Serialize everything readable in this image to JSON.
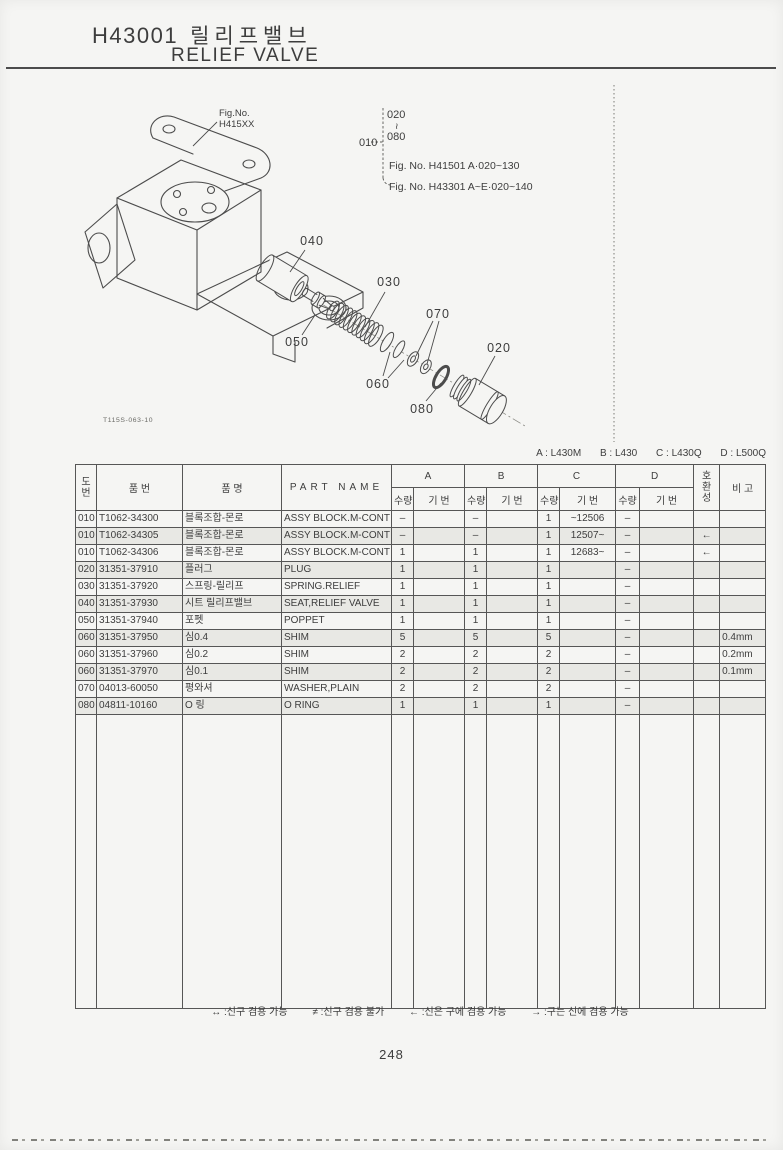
{
  "page": {
    "title_code": "H43001",
    "title_kr": "릴리프밸브",
    "title_en": "RELIEF VALVE",
    "page_number": "248"
  },
  "diagram": {
    "fig_no_label": "Fig.No.",
    "fig_no_value": "H415XX",
    "drawing_code": "T115S-063-10",
    "callouts": {
      "c010": "010",
      "c020": "020",
      "c030": "030",
      "c040": "040",
      "c050": "050",
      "c060": "060",
      "c070": "070",
      "c080": "080"
    },
    "serial_note": {
      "item": "010",
      "range_start": "020",
      "range_end": "080",
      "tilde": "~",
      "refs": [
        "Fig. No. H41501  A·020~130",
        "Fig. No. H43301  A~E·020~140"
      ]
    }
  },
  "models_note": {
    "items": [
      "A : L430M",
      "B : L430",
      "C : L430Q",
      "D : L500Q"
    ]
  },
  "table": {
    "headers": {
      "fig_no": [
        "도",
        "번"
      ],
      "part_no": "품    번",
      "name_kr": "품    명",
      "part_name": "PART NAME",
      "group_a": "A",
      "group_b": "B",
      "group_c": "C",
      "group_d": "D",
      "qty": "수량",
      "serial": "기 번",
      "compat": [
        "호",
        "환",
        "성"
      ],
      "remark": "비  고"
    },
    "rows": [
      {
        "no": "010",
        "part_no": "T1062-34300",
        "name_kr": "블록조합-몬로",
        "name_en": "ASSY BLOCK.M-CONT",
        "a_qty": "–",
        "a_ser": "",
        "b_qty": "–",
        "b_ser": "",
        "c_qty": "1",
        "c_ser": "~12506",
        "d_qty": "–",
        "d_ser": "",
        "compat": "",
        "remark": ""
      },
      {
        "no": "010",
        "part_no": "T1062-34305",
        "name_kr": "블록조합-몬로",
        "name_en": "ASSY BLOCK.M-CONT",
        "a_qty": "–",
        "a_ser": "",
        "b_qty": "–",
        "b_ser": "",
        "c_qty": "1",
        "c_ser": "12507~",
        "d_qty": "–",
        "d_ser": "",
        "compat": "←",
        "remark": ""
      },
      {
        "no": "010",
        "part_no": "T1062-34306",
        "name_kr": "블록조합-몬로",
        "name_en": "ASSY BLOCK.M-CONT",
        "a_qty": "1",
        "a_ser": "",
        "b_qty": "1",
        "b_ser": "",
        "c_qty": "1",
        "c_ser": "12683~",
        "d_qty": "–",
        "d_ser": "",
        "compat": "←",
        "remark": ""
      },
      {
        "no": "020",
        "part_no": "31351-37910",
        "name_kr": "플러그",
        "name_en": "PLUG",
        "a_qty": "1",
        "a_ser": "",
        "b_qty": "1",
        "b_ser": "",
        "c_qty": "1",
        "c_ser": "",
        "d_qty": "–",
        "d_ser": "",
        "compat": "",
        "remark": ""
      },
      {
        "no": "030",
        "part_no": "31351-37920",
        "name_kr": "스프링-릴리프",
        "name_en": "SPRING.RELIEF",
        "a_qty": "1",
        "a_ser": "",
        "b_qty": "1",
        "b_ser": "",
        "c_qty": "1",
        "c_ser": "",
        "d_qty": "–",
        "d_ser": "",
        "compat": "",
        "remark": ""
      },
      {
        "no": "040",
        "part_no": "31351-37930",
        "name_kr": "시트 릴리프밸브",
        "name_en": "SEAT,RELIEF VALVE",
        "a_qty": "1",
        "a_ser": "",
        "b_qty": "1",
        "b_ser": "",
        "c_qty": "1",
        "c_ser": "",
        "d_qty": "–",
        "d_ser": "",
        "compat": "",
        "remark": ""
      },
      {
        "no": "050",
        "part_no": "31351-37940",
        "name_kr": "포펫",
        "name_en": "POPPET",
        "a_qty": "1",
        "a_ser": "",
        "b_qty": "1",
        "b_ser": "",
        "c_qty": "1",
        "c_ser": "",
        "d_qty": "–",
        "d_ser": "",
        "compat": "",
        "remark": ""
      },
      {
        "no": "060",
        "part_no": "31351-37950",
        "name_kr": "심0.4",
        "name_en": "SHIM",
        "a_qty": "5",
        "a_ser": "",
        "b_qty": "5",
        "b_ser": "",
        "c_qty": "5",
        "c_ser": "",
        "d_qty": "–",
        "d_ser": "",
        "compat": "",
        "remark": "0.4mm"
      },
      {
        "no": "060",
        "part_no": "31351-37960",
        "name_kr": "심0.2",
        "name_en": "SHIM",
        "a_qty": "2",
        "a_ser": "",
        "b_qty": "2",
        "b_ser": "",
        "c_qty": "2",
        "c_ser": "",
        "d_qty": "–",
        "d_ser": "",
        "compat": "",
        "remark": "0.2mm"
      },
      {
        "no": "060",
        "part_no": "31351-37970",
        "name_kr": "심0.1",
        "name_en": "SHIM",
        "a_qty": "2",
        "a_ser": "",
        "b_qty": "2",
        "b_ser": "",
        "c_qty": "2",
        "c_ser": "",
        "d_qty": "–",
        "d_ser": "",
        "compat": "",
        "remark": "0.1mm"
      },
      {
        "no": "070",
        "part_no": "04013-60050",
        "name_kr": "평와셔",
        "name_en": "WASHER,PLAIN",
        "a_qty": "2",
        "a_ser": "",
        "b_qty": "2",
        "b_ser": "",
        "c_qty": "2",
        "c_ser": "",
        "d_qty": "–",
        "d_ser": "",
        "compat": "",
        "remark": ""
      },
      {
        "no": "080",
        "part_no": "04811-10160",
        "name_kr": "O 링",
        "name_en": "O RING",
        "a_qty": "1",
        "a_ser": "",
        "b_qty": "1",
        "b_ser": "",
        "c_qty": "1",
        "c_ser": "",
        "d_qty": "–",
        "d_ser": "",
        "compat": "",
        "remark": ""
      }
    ]
  },
  "legend": {
    "items": [
      "↔ :신구 겸용 가능",
      "≠ :신구 겸용 불가",
      "← :신은 구에 겸용 가능",
      "→ :구는 신에 겸용 가능"
    ]
  }
}
